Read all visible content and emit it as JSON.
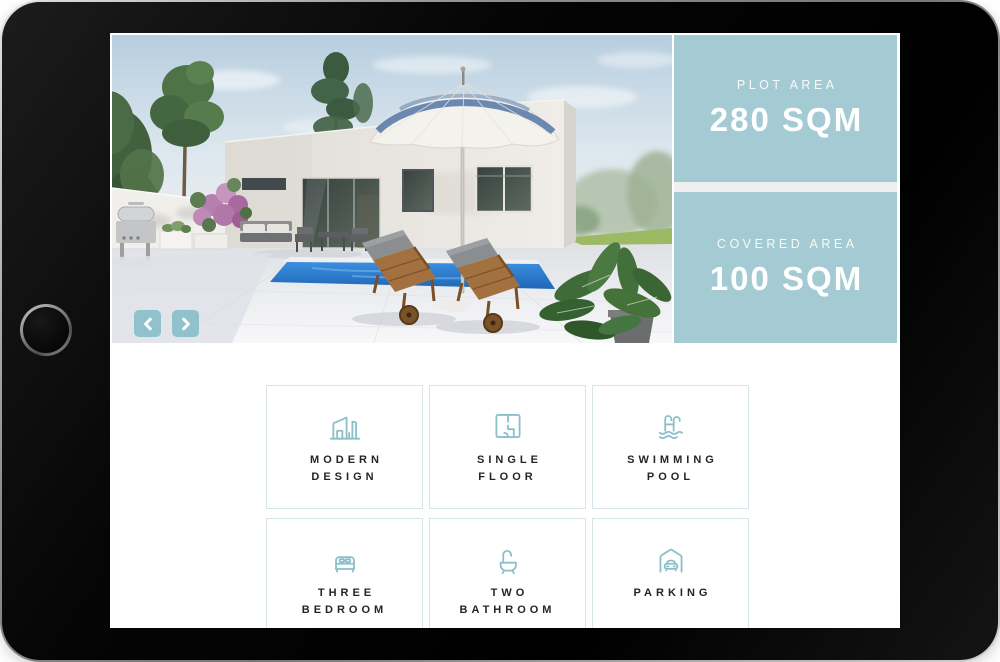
{
  "device": {
    "name": "tablet",
    "home_button": "home-button"
  },
  "photo": {
    "carousel": {
      "prev_icon": "chevron-left-icon",
      "next_icon": "chevron-right-icon"
    }
  },
  "stats": {
    "plot": {
      "label": "PLOT AREA",
      "value": "280 SQM"
    },
    "covered": {
      "label": "COVERED AREA",
      "value": "100 SQM"
    }
  },
  "features": [
    {
      "icon": "modern-house-icon",
      "label": "MODERN\nDESIGN"
    },
    {
      "icon": "floor-plan-icon",
      "label": "SINGLE\nFLOOR"
    },
    {
      "icon": "swimming-pool-icon",
      "label": "SWIMMING\nPOOL"
    },
    {
      "icon": "bed-icon",
      "label": "THREE\nBEDROOM"
    },
    {
      "icon": "bathtub-icon",
      "label": "TWO\nBATHROOM"
    },
    {
      "icon": "garage-car-icon",
      "label": "PARKING"
    }
  ],
  "colors": {
    "panel_teal": "#a4cbd3",
    "arrow_teal": "#90c2cb",
    "icon_teal": "#8cbfca",
    "card_border": "#d7e5e9",
    "label_text": "#232527",
    "panel_text": "#ffffff",
    "bezel_black": "#060606"
  }
}
